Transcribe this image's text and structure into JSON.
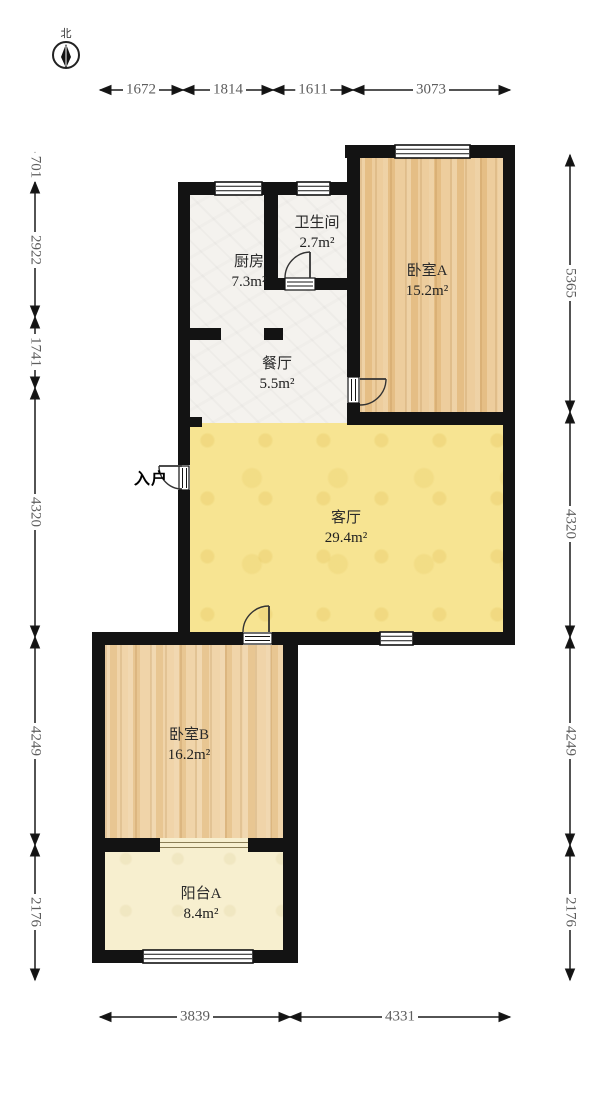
{
  "plan": {
    "compass_label": "北",
    "entrance_label": "入户",
    "rooms": {
      "kitchen": {
        "name": "厨房",
        "area": "7.3m²"
      },
      "bathroom": {
        "name": "卫生间",
        "area": "2.7m²"
      },
      "bedroom_a": {
        "name": "卧室A",
        "area": "15.2m²"
      },
      "dining": {
        "name": "餐厅",
        "area": "5.5m²"
      },
      "living": {
        "name": "客厅",
        "area": "29.4m²"
      },
      "bedroom_b": {
        "name": "卧室B",
        "area": "16.2m²"
      },
      "balcony_a": {
        "name": "阳台A",
        "area": "8.4m²"
      }
    },
    "dimensions_mm": {
      "top": [
        "1672",
        "1814",
        "1611",
        "3073"
      ],
      "left": [
        "701",
        "2922",
        "1741",
        "4320",
        "4249",
        "2176"
      ],
      "right": [
        "5365",
        "4320",
        "4249",
        "2176"
      ],
      "bottom": [
        "3839",
        "4331"
      ]
    },
    "colors": {
      "wall": "#131313",
      "living_floor": "#f7e492",
      "bedroom_floor": "#eac58d",
      "balcony_floor": "#f7efcf",
      "tile_floor": "#f4f2ee"
    }
  }
}
